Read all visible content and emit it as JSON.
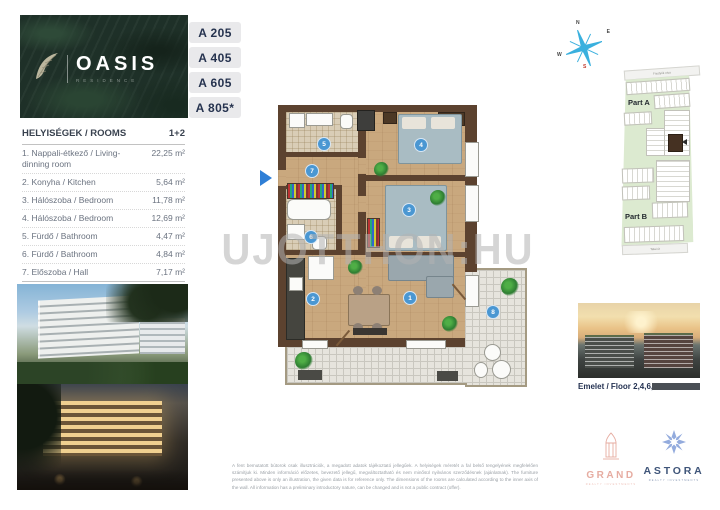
{
  "brand": {
    "name": "OASIS",
    "subtitle": "RESIDENCE"
  },
  "units": [
    {
      "label": "A 205"
    },
    {
      "label": "A 405"
    },
    {
      "label": "A 605"
    },
    {
      "label": "A 805*"
    }
  ],
  "rooms_table": {
    "header_left": "HELYISÉGEK / ROOMS",
    "header_right": "1+2",
    "rows": [
      {
        "label": "1. Nappali-étkező / Living-dinning room",
        "value": "22,25 m²"
      },
      {
        "label": "2. Konyha / Kitchen",
        "value": "5,64 m²"
      },
      {
        "label": "3. Hálószoba / Bedroom",
        "value": "11,78 m²"
      },
      {
        "label": "4. Hálószoba / Bedroom",
        "value": "12,69 m²"
      },
      {
        "label": "5. Fürdő / Bathroom",
        "value": "4,47 m²"
      },
      {
        "label": "6. Fürdő / Bathroom",
        "value": "4,84 m²"
      },
      {
        "label": "7. Előszoba / Hall",
        "value": "7,17 m²"
      }
    ],
    "gross_label": "BRUTTO TERÜLET / GROSS AREA",
    "gross_value": "70,35 m²",
    "balcony_label": "8. Erkély / Balcony",
    "balcony_value": "21,08 m²",
    "total_label": "TOTAL",
    "total_value": "80,89 m²"
  },
  "floor_plan": {
    "watermark": "UJOTTHON:HU",
    "numbers": {
      "living": "1",
      "kitchen": "2",
      "bedroom_a": "3",
      "bedroom_b": "4",
      "bathroom_a": "5",
      "bathroom_b": "6",
      "hall": "7",
      "balcony": "8"
    }
  },
  "site_map": {
    "part_a": "Part A",
    "part_b": "Part B",
    "street_top": "Fiastyúk utca",
    "street_bottom": "Tatai út",
    "compass": {
      "n": "N",
      "e": "E",
      "s": "S",
      "w": "W"
    }
  },
  "floor_photo_caption": "Emelet / Floor 2,4,6,8",
  "logos": {
    "grand_name": "GRAND",
    "grand_subtitle": "REALTY INVESTMENTS",
    "astora_name": "ASTORA",
    "astora_subtitle": "REALTY INVESTMENTS"
  },
  "disclaimer_hu": "A fent bemutatott bútorok csak illusztrációk, a megadott adatok tájékoztató jellegűek. A helyiségek méretét a fal belső tengelyének megfelelően számítjuk ki. Minden információ előzetes, bevezető jellegű, megváltoztatható és nem minősül nyilvános szerződésnek (ajánlatnak).",
  "disclaimer_en": "The furniture presented above is only an illustration, the given data is for reference only. The dimensions of the rooms are calculated according to the inner axis of the wall. All information has a preliminary introductory nature, can be changed and is not a public contract (offer).",
  "colors": {
    "accent_navy": "#26334f",
    "tab_bg": "#e9e9eb",
    "circle_blue": "#4a97d2",
    "map_green": "#dcead0",
    "grand_pink": "#e6aca1",
    "astora_blue": "#93abdd",
    "wall_brown": "#5c422f"
  }
}
